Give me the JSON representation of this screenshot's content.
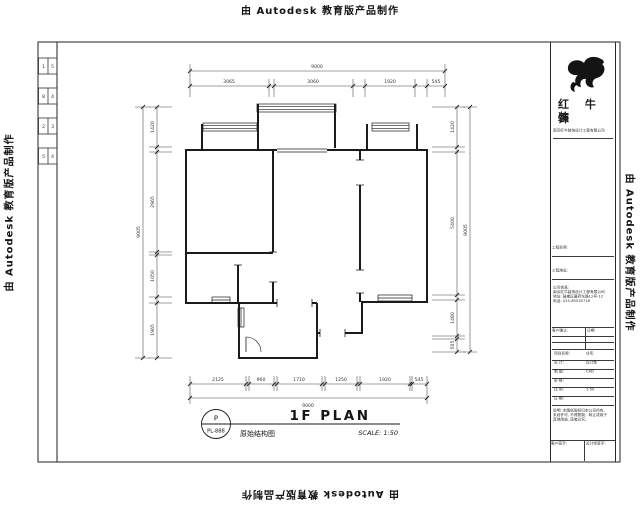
{
  "watermark": {
    "text": "由 Autodesk 教育版产品制作"
  },
  "sheet": {
    "margin_boxes": [
      [
        "1",
        "5"
      ],
      [
        "8",
        "4"
      ],
      [
        "2",
        "3"
      ],
      [
        "5",
        "4"
      ]
    ]
  },
  "plan": {
    "dims": {
      "top_overall": "9000",
      "top_segments": [
        "3065",
        "3060",
        "1920",
        "545"
      ],
      "bottom_segments": [
        "2125",
        "960",
        "1710",
        "1250",
        "1920",
        "545"
      ],
      "bottom_overall": "9000",
      "left_segments": [
        "1420",
        "2965",
        "1050",
        "1965"
      ],
      "left_overall": "9005",
      "right_segments": [
        "1420",
        "5400",
        "1480",
        "505"
      ],
      "right_overall": "9005"
    },
    "label": {
      "circle_top": "P",
      "circle_code": "PL-888",
      "cn_name": "原始结构图",
      "title": "1F PLAN",
      "scale": "SCALE: 1:50"
    }
  },
  "title_block": {
    "brand_line1": "红 牛 装",
    "brand_line2": "饰",
    "company_small": "南京红牛装饰设计工程有限公司",
    "row_project": "工程名称:",
    "row_address": "工程地址:",
    "info_title": "公司信息:",
    "info_line1": "南京红牛装饰设计工程有限公司",
    "info_line2": "地址: 鼓楼区幕府东路12号-12",
    "info_line3": "电话: 025-85530716",
    "th_left": "客户确认:",
    "th_right": "日期:",
    "fields": [
      {
        "l": "项目名称:",
        "v": "住宅"
      },
      {
        "l": "设  计:",
        "v": "设计部"
      },
      {
        "l": "制  图:",
        "v": "CAD"
      },
      {
        "l": "审  核:",
        "v": " "
      },
      {
        "l": "比  例:",
        "v": "1:50"
      },
      {
        "l": "日  期:",
        "v": " "
      }
    ],
    "notes1": "说明: 本图纸版权归本公司所有,",
    "notes2": "未经许可, 不得复制、转让或用于",
    "notes3": "其他用途, 违者必究。",
    "foot_left": "客户签字:",
    "foot_right": "设计师签字:"
  }
}
